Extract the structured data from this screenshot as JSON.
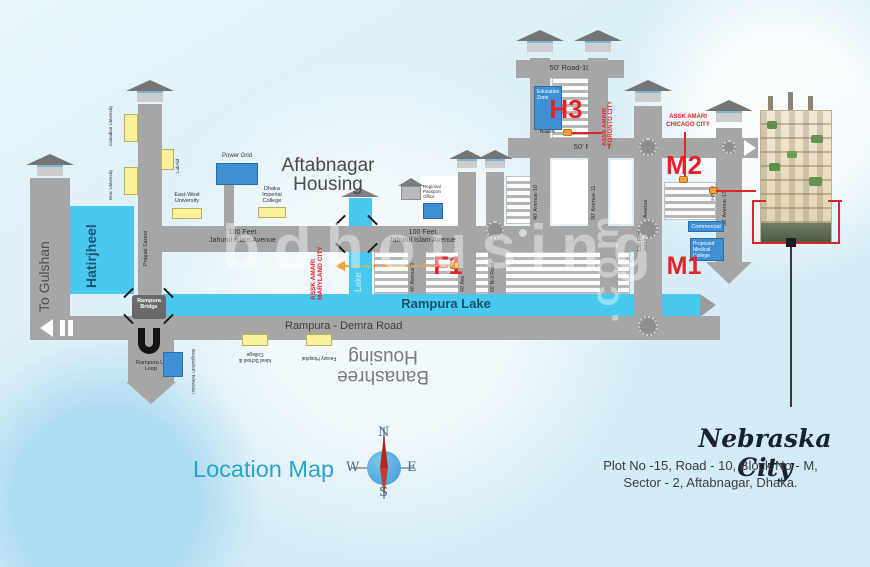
{
  "watermark": {
    "text": "bdhousing",
    "suffix": ".com"
  },
  "titles": {
    "location_map": "Location Map",
    "aftabnagar_l1": "Aftabnagar",
    "aftabnagar_l2": "Housing",
    "banashree_l1": "Banashree",
    "banashree_l2": "Housing"
  },
  "project": {
    "name": "Nebraska City",
    "address1": "Plot No -15, Road - 10, Block No -  M,",
    "address2": "Sector - 2, Aftabnagar, Dhaka."
  },
  "compass": {
    "n": "N",
    "e": "E",
    "w": "W",
    "s": "S"
  },
  "roads": {
    "to_gulshan": "To Gulshan",
    "pragati": "Pragati Sarani",
    "av100_l1": "100 Feet",
    "av100_l2": "Jahurul Islam Avenue",
    "av130_l1": "130 Feet",
    "av130_l2": "Jahurul Islam Avenue",
    "demra": "Rampura - Demra Road",
    "road10": "50' Road-10",
    "road9": "50' Road-9",
    "road9_sm": "Road-9",
    "road8_sm": "Road-8",
    "av9": "40' Avenue-9",
    "av_mid": "40' Ave",
    "n3": "60' N-3 Road",
    "av10": "40' Avenue-10",
    "av11": "50' Avenue-11",
    "av13": "50' Avenue-13"
  },
  "water": {
    "hatirjheel": "Hatirjheel",
    "rampura_lake": "Rampura Lake",
    "lake": "Lake"
  },
  "structures": {
    "bridge": "Rampura Bridge",
    "uloop": "Rampura U-Loop"
  },
  "landmarks": {
    "canadian": "Canadian University",
    "labaid": "LabAid",
    "brac": "Brac University",
    "east_west": "East-West University",
    "power_grid": "Power Grid",
    "imperial": "Dhaka Imperial College",
    "passport": "Regional Passport Office",
    "education_zone": "Education Zone",
    "commercial": "Commercial",
    "medical": "Proposed Medical College",
    "btv": "Bangladesh Television",
    "ideal": "Ideal School & College",
    "farazy": "Farazy Hospital"
  },
  "markers": {
    "f1": "F1",
    "h3": "H3",
    "m1": "M1",
    "m2": "M2",
    "maryland1": "ASSK AMARI",
    "maryland2": "MARYLAND CITY",
    "toronto1": "ASSK AMARI",
    "toronto2": "TORONTO CITY",
    "chicago1": "ASSK AMARI",
    "chicago2": "CHICAGO CITY"
  },
  "colors": {
    "road_gray": "#a6a6a6",
    "lake_blue": "#49c9f0",
    "box_yellow": "#f9f19b",
    "box_blue": "#3f8fd4",
    "accent_red": "#e62229",
    "marker_orange": "#f2a33c",
    "title_teal": "#2aa5c8",
    "text_navy": "#18222e"
  }
}
